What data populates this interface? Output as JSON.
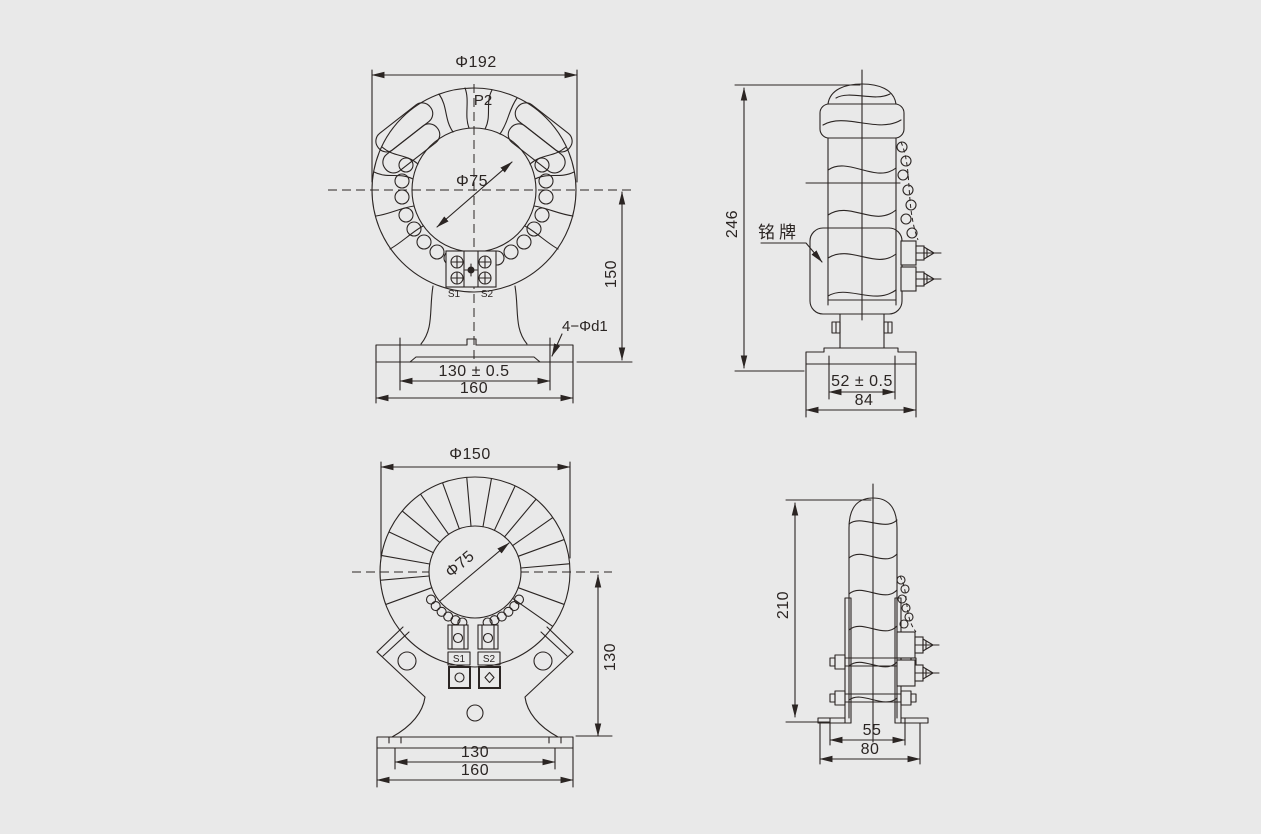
{
  "page": {
    "background": "#e9e9e9",
    "line_color": "#2b2523",
    "kind": "technical dimension drawing, 4 views of toroidal current transformers"
  },
  "views": {
    "front_large": {
      "dim_outer": "Φ192",
      "dim_bore": "Φ75",
      "label_p2": "P2",
      "label_s1": "S1",
      "label_s2": "S2",
      "dim_height": "150",
      "dim_holes": "4−Φd1",
      "dim_slots": "130 ± 0.5",
      "dim_base": "160"
    },
    "side_large": {
      "dim_height": "246",
      "label_nameplate": "铭牌",
      "dim_slots": "52 ± 0.5",
      "dim_base": "84"
    },
    "front_small": {
      "dim_outer": "Φ150",
      "dim_bore": "Φ75",
      "label_s1": "S1",
      "label_s2": "S2",
      "dim_height": "130",
      "dim_slots": "130",
      "dim_base": "160"
    },
    "side_small": {
      "dim_height": "210",
      "dim_slots": "55",
      "dim_base": "80"
    }
  }
}
